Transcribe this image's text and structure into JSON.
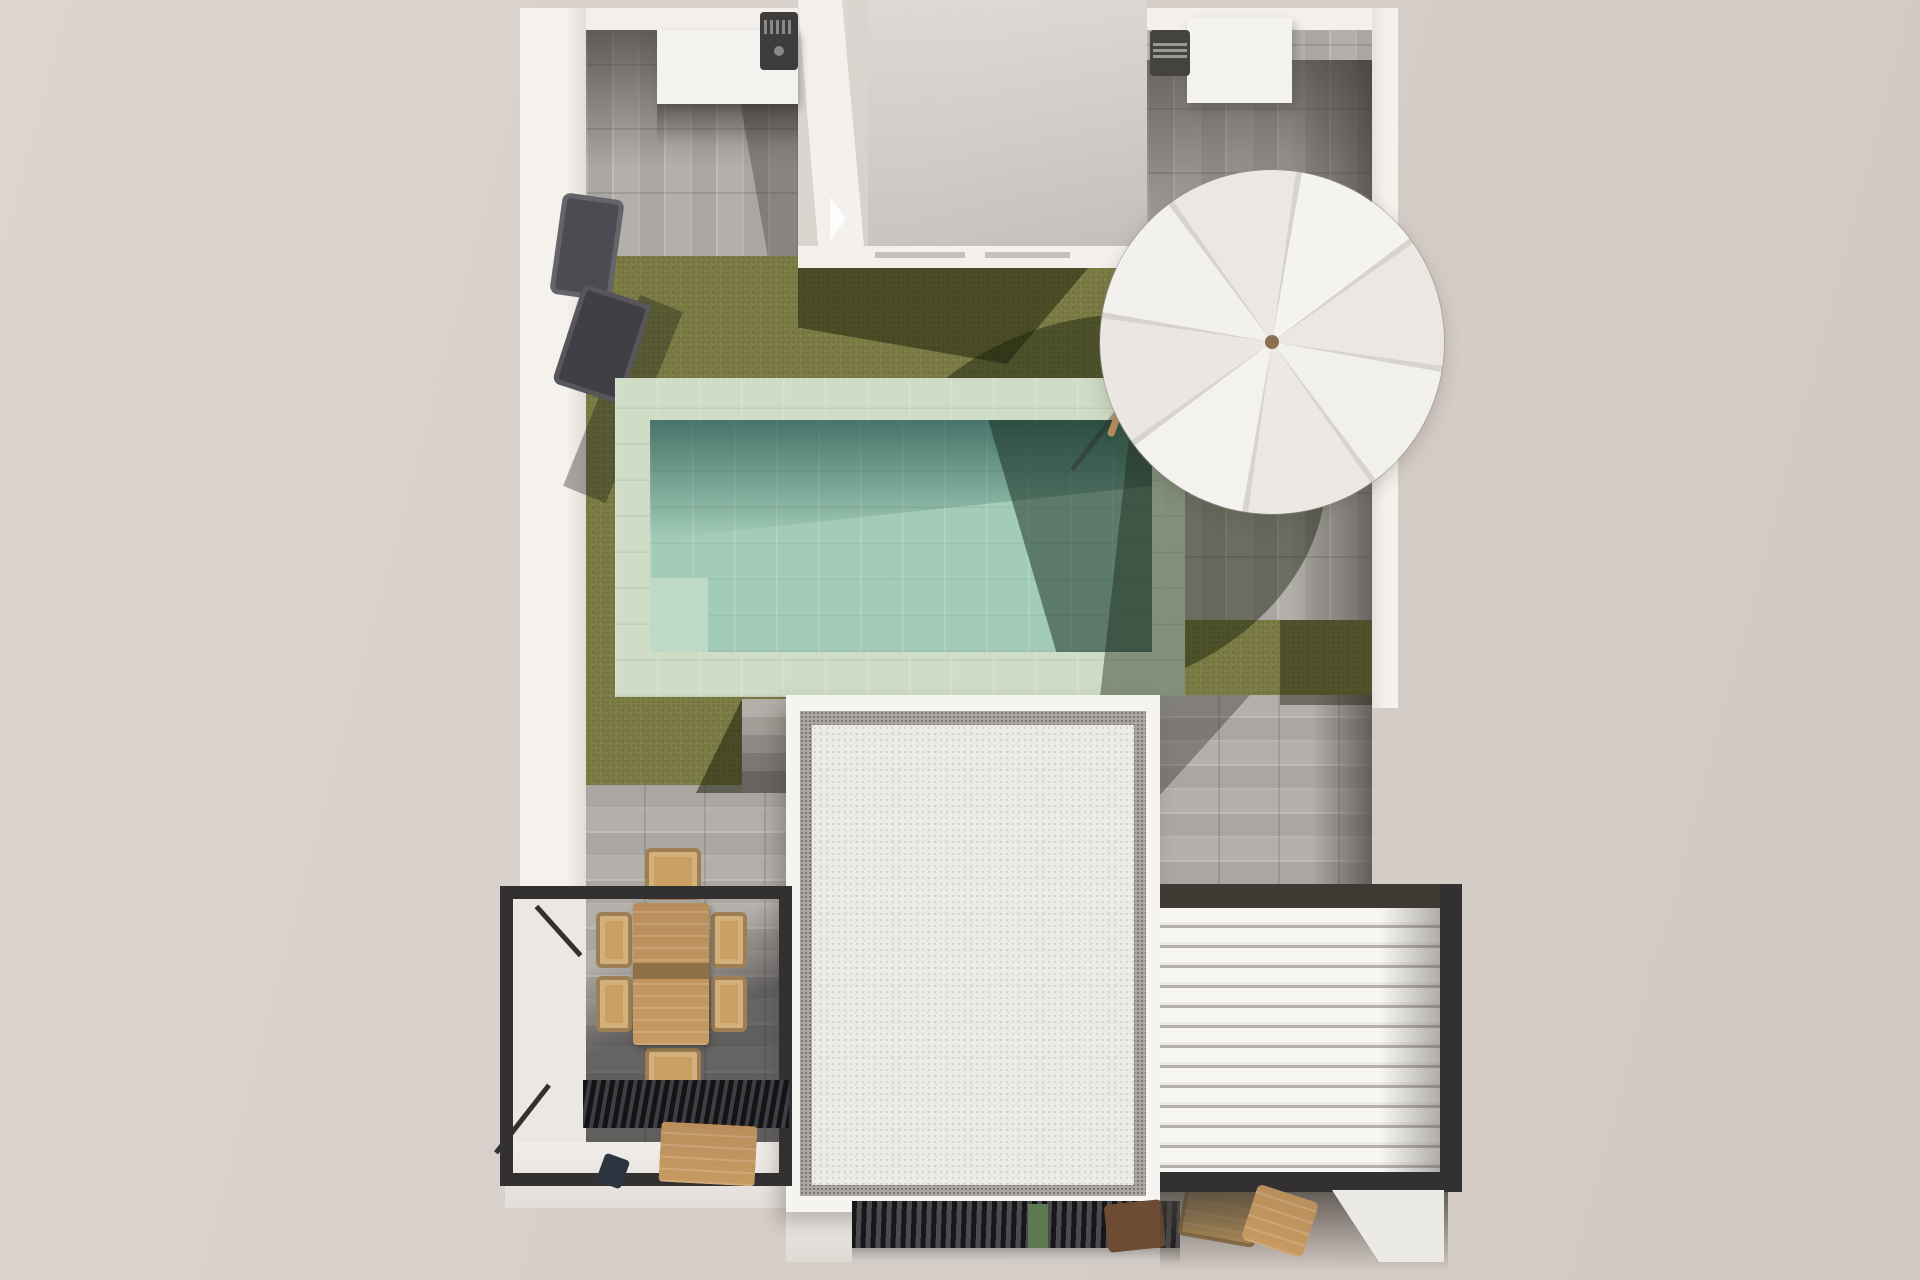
{
  "meta": {
    "description": "Top-down 3D architectural render of a walled villa plot: paved courtyards, lawn with rectangular pool, white parasol, flat-roofed house, dining pergola with black frame, white louvered pergola roof and barbecue units",
    "text_content": "none (image contains no visible text)"
  },
  "palette": {
    "ground_outside": "#d6cec8",
    "wall_white": "#f3f0ec",
    "wall_shade": "#ddd8d3",
    "paving_base": "#b3afaa",
    "paving_light": "#c0bcb7",
    "grass": "#7c7c45",
    "grass_shadow": "rgba(22,30,10,0.46)",
    "pool_coping": "#cfdcc6",
    "pool_water": "#a2ccb8",
    "pool_water_shadow": "rgba(16,64,58,0.62)",
    "pool_bench": "#c0dac8",
    "house_roof_flat": "#d6d0cb",
    "building_stucco": "#ecebe7",
    "building_parapet": "#f6f4f1",
    "building_border_speckle": "#a9a6a4",
    "pergola_frame_black": "#323030",
    "pergola_bar_brown": "#3f3933",
    "louver_white": "#f7f6f3",
    "grate_black": "#17171a",
    "wood_table": "#c89a62",
    "wood_runner": "#8f6f46",
    "wood_chair": "#c9a061",
    "wood_dark": "#6e4c33",
    "lounger_dark": "#4b4b52",
    "umbrella_white": "#f4f2ee",
    "umbrella_hub": "#8d6e4e",
    "step_light": "#b3afa9",
    "step_dark": "#68645f",
    "plant_green": "#5c7a50",
    "white_floor": "#ebe8e4"
  },
  "scene": {
    "plot": {
      "walls": "white perimeter walls",
      "orientation": "top-down aerial"
    },
    "upper_left_court": {
      "surface": "grey plank paving",
      "objects": [
        "outdoor-kitchen-box",
        "barbecue-grill",
        "double-sun-lounger"
      ]
    },
    "house_top": {
      "type": "flat roof block",
      "features": [
        "white parapet",
        "two roof grooves"
      ]
    },
    "upper_right_court": {
      "surface": "grey plank paving",
      "objects": [
        "outdoor-kitchen-box",
        "barbecue-grill",
        "leaning-wooden-pole",
        "white-parasol"
      ]
    },
    "garden": {
      "surface": "lawn",
      "objects": [
        "rectangular pool with pale stone coping",
        "underwater bench",
        "five stone steps"
      ]
    },
    "pool": {
      "coping": "pale mint stone tiles",
      "water": "turquoise with shadowed band"
    },
    "lower_terrace": {
      "surface": "grey plank paving",
      "objects": [
        "wooden dining table",
        "six wicker chairs",
        "black pergola frame",
        "black louvered grate",
        "wooden bench"
      ]
    },
    "building": {
      "type": "white gravel flat roof",
      "border": "grey speckled inset band"
    },
    "right_pergola": {
      "roof": "white louvered slats",
      "frame": "dark charcoal"
    },
    "bottom": {
      "objects": [
        "black slatted vent strip",
        "small plant",
        "stacked wooden chairs"
      ]
    }
  }
}
